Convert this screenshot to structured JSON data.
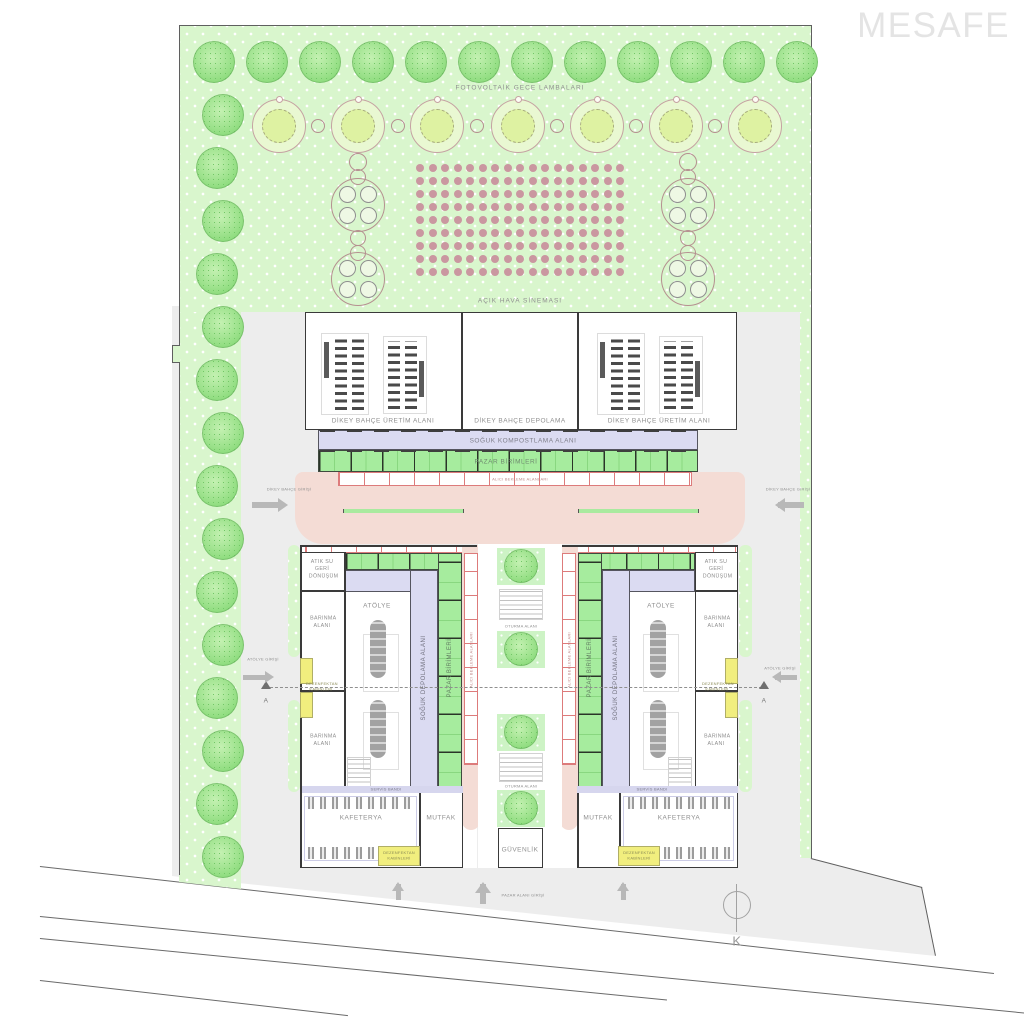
{
  "watermark": "MESAFE",
  "park": {
    "pv_lamps_label": "FOTOVOLTAİK GECE LAMBALARI",
    "cinema_label": "AÇIK HAVA SİNEMASI"
  },
  "halls": {
    "left": "DİKEY BAHÇE ÜRETİM ALANI",
    "center": "DİKEY BAHÇE DEPOLAMA",
    "right": "DİKEY BAHÇE ÜRETİM ALANI"
  },
  "bands": {
    "compost": "SOĞUK KOMPOSTLAMA ALANI",
    "market": "PAZAR BİRİMLERİ",
    "waiting": "ALICI BEKLEME ALANLARI"
  },
  "left_wing": {
    "waste_water": "ATIK SU GERİ DÖNÜŞÜM",
    "shelter_top": "BARINMA ALANI",
    "workshop": "ATÖLYE",
    "shelter_bottom": "BARINMA ALANI",
    "cold_storage": "SOĞUK DEPOLAMA ALANI",
    "market_units": "PAZAR BİRİMLERİ",
    "waiting_area": "ALICI BEKLEME ALANLARI",
    "service_band": "SERVİS BANDI",
    "cafeteria": "KAFETERYA",
    "kitchen": "MUTFAK",
    "disinfection_side": "DEZENFEKTAN KABİNLERİ",
    "disinfection_bottom": "DEZENFEKTAN KABİNLERİ"
  },
  "right_wing": {
    "waste_water": "ATIK SU GERİ DÖNÜŞÜM",
    "shelter_top": "BARINMA ALANI",
    "workshop": "ATÖLYE",
    "shelter_bottom": "BARINMA ALANI",
    "cold_storage": "SOĞUK DEPOLAMA ALANI",
    "market_units": "PAZAR BİRİMLERİ",
    "waiting_area": "ALICI BEKLEME ALANLARI",
    "service_band": "SERVİS BANDI",
    "cafeteria": "KAFETERYA",
    "kitchen": "MUTFAK",
    "disinfection_side": "DEZENFEKTAN KABİNLERİ",
    "disinfection_bottom": "DEZENFEKTAN KABİNLERİ"
  },
  "plaza": {
    "seating_upper": "OTURMA ALANI",
    "seating_lower": "OTURMA ALANI",
    "security": "GÜVENLİK"
  },
  "entrances": {
    "garden_left": "DİKEY BAHÇE GİRİŞİ",
    "garden_right": "DİKEY BAHÇE GİRİŞİ",
    "workshop_left": "ATÖLYE GİRİŞİ",
    "workshop_right": "ATÖLYE GİRİŞİ",
    "market_gate": "PAZAR ALANI GİRİŞİ"
  },
  "markers": {
    "section": "A",
    "north": "K",
    "distance": "2m"
  },
  "colors": {
    "park_green": "#d9f6cd",
    "tree_green": "#90dd80",
    "band_purple": "#dbdbf2",
    "band_green": "#a6ec9e",
    "corridor_pink": "#f4dcd5",
    "cell_red": "#dd7b7b",
    "disinfect_yellow": "#f1ee7e",
    "dot_pink": "#ca97a0",
    "paving_gray": "#ededed"
  }
}
